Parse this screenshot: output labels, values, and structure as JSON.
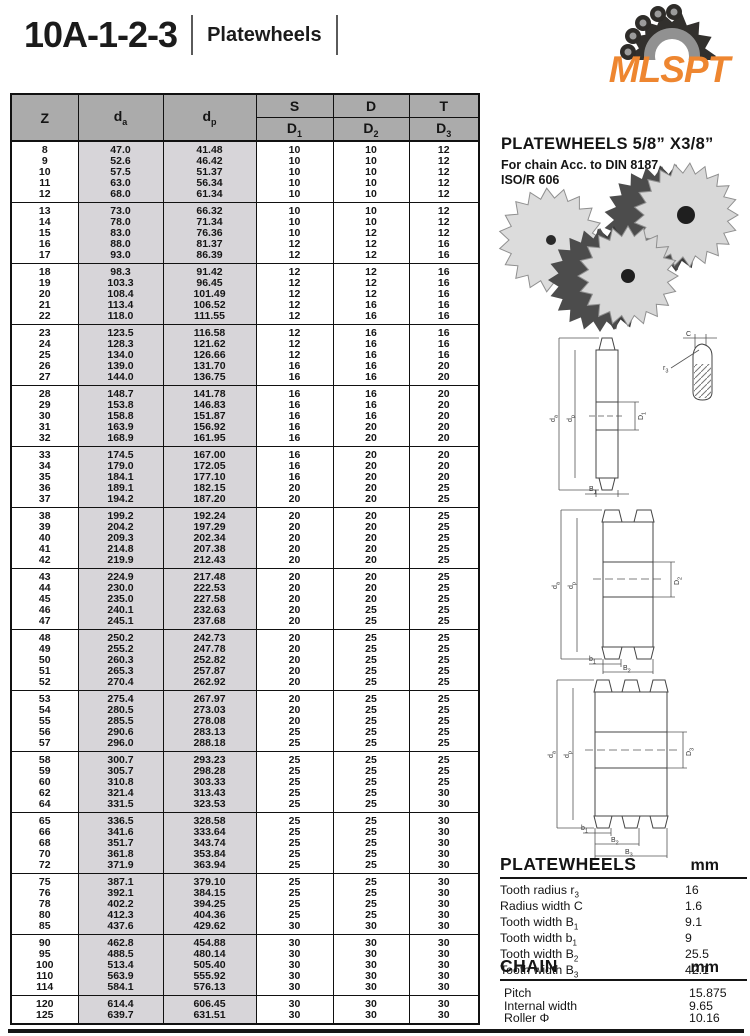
{
  "header": {
    "title": "10A-1-2-3",
    "subtitle": "Platewheels"
  },
  "logo": {
    "text": "MLSPT",
    "color": "#EE8630",
    "icon": "sprocket-chain-icon"
  },
  "colors": {
    "accent_orange": "#EE8630",
    "table_header_gray": "#ababab",
    "shaded_column": "#d7d5d9"
  },
  "panel": {
    "heading": "PLATEWHEELS 5/8” X3/8”",
    "sub1": "For chain Acc. to DIN 8187",
    "sub2": "ISO/R 606"
  },
  "table": {
    "col_z": "Z",
    "col_da": {
      "base": "d",
      "sub": "a"
    },
    "col_dp": {
      "base": "d",
      "sub": "p"
    },
    "col_s": "S",
    "col_d": "D",
    "col_t": "T",
    "col_d1": {
      "base": "D",
      "sub": "1"
    },
    "col_d2": {
      "base": "D",
      "sub": "2"
    },
    "col_d3": {
      "base": "D",
      "sub": "3"
    },
    "groups": [
      [
        [
          "8",
          "47.0",
          "41.48",
          "10",
          "10",
          "12"
        ],
        [
          "9",
          "52.6",
          "46.42",
          "10",
          "10",
          "12"
        ],
        [
          "10",
          "57.5",
          "51.37",
          "10",
          "10",
          "12"
        ],
        [
          "11",
          "63.0",
          "56.34",
          "10",
          "10",
          "12"
        ],
        [
          "12",
          "68.0",
          "61.34",
          "10",
          "10",
          "12"
        ]
      ],
      [
        [
          "13",
          "73.0",
          "66.32",
          "10",
          "10",
          "12"
        ],
        [
          "14",
          "78.0",
          "71.34",
          "10",
          "10",
          "12"
        ],
        [
          "15",
          "83.0",
          "76.36",
          "10",
          "12",
          "12"
        ],
        [
          "16",
          "88.0",
          "81.37",
          "12",
          "12",
          "16"
        ],
        [
          "17",
          "93.0",
          "86.39",
          "12",
          "12",
          "16"
        ]
      ],
      [
        [
          "18",
          "98.3",
          "91.42",
          "12",
          "12",
          "16"
        ],
        [
          "19",
          "103.3",
          "96.45",
          "12",
          "12",
          "16"
        ],
        [
          "20",
          "108.4",
          "101.49",
          "12",
          "12",
          "16"
        ],
        [
          "21",
          "113.4",
          "106.52",
          "12",
          "16",
          "16"
        ],
        [
          "22",
          "118.0",
          "111.55",
          "12",
          "16",
          "16"
        ]
      ],
      [
        [
          "23",
          "123.5",
          "116.58",
          "12",
          "16",
          "16"
        ],
        [
          "24",
          "128.3",
          "121.62",
          "12",
          "16",
          "16"
        ],
        [
          "25",
          "134.0",
          "126.66",
          "12",
          "16",
          "16"
        ],
        [
          "26",
          "139.0",
          "131.70",
          "16",
          "16",
          "20"
        ],
        [
          "27",
          "144.0",
          "136.75",
          "16",
          "16",
          "20"
        ]
      ],
      [
        [
          "28",
          "148.7",
          "141.78",
          "16",
          "16",
          "20"
        ],
        [
          "29",
          "153.8",
          "146.83",
          "16",
          "16",
          "20"
        ],
        [
          "30",
          "158.8",
          "151.87",
          "16",
          "16",
          "20"
        ],
        [
          "31",
          "163.9",
          "156.92",
          "16",
          "20",
          "20"
        ],
        [
          "32",
          "168.9",
          "161.95",
          "16",
          "20",
          "20"
        ]
      ],
      [
        [
          "33",
          "174.5",
          "167.00",
          "16",
          "20",
          "20"
        ],
        [
          "34",
          "179.0",
          "172.05",
          "16",
          "20",
          "20"
        ],
        [
          "35",
          "184.1",
          "177.10",
          "16",
          "20",
          "20"
        ],
        [
          "36",
          "189.1",
          "182.15",
          "20",
          "20",
          "25"
        ],
        [
          "37",
          "194.2",
          "187.20",
          "20",
          "20",
          "25"
        ]
      ],
      [
        [
          "38",
          "199.2",
          "192.24",
          "20",
          "20",
          "25"
        ],
        [
          "39",
          "204.2",
          "197.29",
          "20",
          "20",
          "25"
        ],
        [
          "40",
          "209.3",
          "202.34",
          "20",
          "20",
          "25"
        ],
        [
          "41",
          "214.8",
          "207.38",
          "20",
          "20",
          "25"
        ],
        [
          "42",
          "219.9",
          "212.43",
          "20",
          "20",
          "25"
        ]
      ],
      [
        [
          "43",
          "224.9",
          "217.48",
          "20",
          "20",
          "25"
        ],
        [
          "44",
          "230.0",
          "222.53",
          "20",
          "20",
          "25"
        ],
        [
          "45",
          "235.0",
          "227.58",
          "20",
          "20",
          "25"
        ],
        [
          "46",
          "240.1",
          "232.63",
          "20",
          "25",
          "25"
        ],
        [
          "47",
          "245.1",
          "237.68",
          "20",
          "25",
          "25"
        ]
      ],
      [
        [
          "48",
          "250.2",
          "242.73",
          "20",
          "25",
          "25"
        ],
        [
          "49",
          "255.2",
          "247.78",
          "20",
          "25",
          "25"
        ],
        [
          "50",
          "260.3",
          "252.82",
          "20",
          "25",
          "25"
        ],
        [
          "51",
          "265.3",
          "257.87",
          "20",
          "25",
          "25"
        ],
        [
          "52",
          "270.4",
          "262.92",
          "20",
          "25",
          "25"
        ]
      ],
      [
        [
          "53",
          "275.4",
          "267.97",
          "20",
          "25",
          "25"
        ],
        [
          "54",
          "280.5",
          "273.03",
          "20",
          "25",
          "25"
        ],
        [
          "55",
          "285.5",
          "278.08",
          "20",
          "25",
          "25"
        ],
        [
          "56",
          "290.6",
          "283.13",
          "25",
          "25",
          "25"
        ],
        [
          "57",
          "296.0",
          "288.18",
          "25",
          "25",
          "25"
        ]
      ],
      [
        [
          "58",
          "300.7",
          "293.23",
          "25",
          "25",
          "25"
        ],
        [
          "59",
          "305.7",
          "298.28",
          "25",
          "25",
          "25"
        ],
        [
          "60",
          "310.8",
          "303.33",
          "25",
          "25",
          "25"
        ],
        [
          "62",
          "321.4",
          "313.43",
          "25",
          "25",
          "30"
        ],
        [
          "64",
          "331.5",
          "323.53",
          "25",
          "25",
          "30"
        ]
      ],
      [
        [
          "65",
          "336.5",
          "328.58",
          "25",
          "25",
          "30"
        ],
        [
          "66",
          "341.6",
          "333.64",
          "25",
          "25",
          "30"
        ],
        [
          "68",
          "351.7",
          "343.74",
          "25",
          "25",
          "30"
        ],
        [
          "70",
          "361.8",
          "353.84",
          "25",
          "25",
          "30"
        ],
        [
          "72",
          "371.9",
          "363.94",
          "25",
          "25",
          "30"
        ]
      ],
      [
        [
          "75",
          "387.1",
          "379.10",
          "25",
          "25",
          "30"
        ],
        [
          "76",
          "392.1",
          "384.15",
          "25",
          "25",
          "30"
        ],
        [
          "78",
          "402.2",
          "394.25",
          "25",
          "25",
          "30"
        ],
        [
          "80",
          "412.3",
          "404.36",
          "25",
          "25",
          "30"
        ],
        [
          "85",
          "437.6",
          "429.62",
          "30",
          "30",
          "30"
        ]
      ],
      [
        [
          "90",
          "462.8",
          "454.88",
          "30",
          "30",
          "30"
        ],
        [
          "95",
          "488.5",
          "480.14",
          "30",
          "30",
          "30"
        ],
        [
          "100",
          "513.4",
          "505.40",
          "30",
          "30",
          "30"
        ],
        [
          "110",
          "563.9",
          "555.92",
          "30",
          "30",
          "30"
        ],
        [
          "114",
          "584.1",
          "576.13",
          "30",
          "30",
          "30"
        ]
      ],
      [
        [
          "120",
          "614.4",
          "606.45",
          "30",
          "30",
          "30"
        ],
        [
          "125",
          "639.7",
          "631.51",
          "30",
          "30",
          "30"
        ]
      ]
    ]
  },
  "drawings": {
    "single": {
      "da": {
        "base": "d",
        "sub": "a"
      },
      "dp": {
        "base": "d",
        "sub": "p"
      },
      "hub": {
        "base": "D",
        "sub": "1"
      },
      "width": {
        "base": "B",
        "sub": "1"
      },
      "c_label": "C",
      "r_label": {
        "base": "r",
        "sub": "3"
      }
    },
    "double": {
      "da": {
        "base": "d",
        "sub": "a"
      },
      "dp": {
        "base": "d",
        "sub": "p"
      },
      "hub": {
        "base": "D",
        "sub": "2"
      },
      "w1": {
        "base": "b",
        "sub": "1"
      },
      "w2": {
        "base": "B",
        "sub": "2"
      }
    },
    "triple": {
      "da": {
        "base": "d",
        "sub": "a"
      },
      "dp": {
        "base": "d",
        "sub": "p"
      },
      "hub": {
        "base": "D",
        "sub": "3"
      },
      "w1": {
        "base": "b",
        "sub": "1"
      },
      "w2": {
        "base": "B",
        "sub": "2"
      },
      "w3": {
        "base": "B",
        "sub": "3"
      }
    }
  },
  "specs": {
    "platewheels": {
      "title": "PLATEWHEELS",
      "unit": "mm",
      "rows": [
        {
          "label": "Tooth radius r",
          "sub": "3",
          "value": "16"
        },
        {
          "label": "Radius width C",
          "sub": "",
          "value": "1.6"
        },
        {
          "label": "Tooth width B",
          "sub": "1",
          "value": "9.1"
        },
        {
          "label": "Tooth width b",
          "sub": "1",
          "value": "9"
        },
        {
          "label": "Tooth width B",
          "sub": "2",
          "value": "25.5"
        },
        {
          "label": "Tooth width B",
          "sub": "3",
          "value": "42.1"
        }
      ]
    },
    "chain": {
      "title": "CHAIN",
      "unit": "mm",
      "rows": [
        {
          "label": "Pitch",
          "sub": "",
          "value": "15.875"
        },
        {
          "label": "Internal width",
          "sub": "",
          "value": "9.65"
        },
        {
          "label": "Roller Φ",
          "sub": "",
          "value": "10.16"
        }
      ]
    }
  }
}
